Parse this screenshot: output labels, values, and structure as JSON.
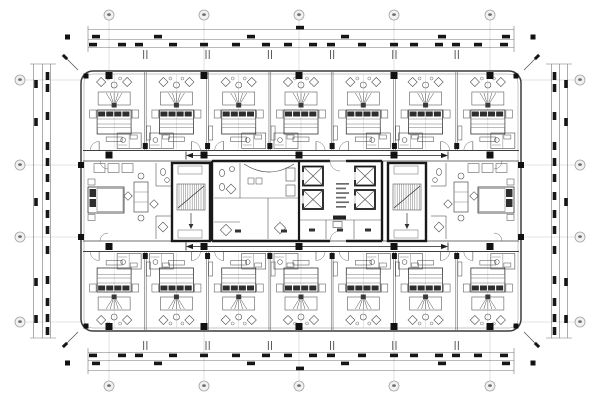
{
  "page": {
    "width": 600,
    "height": 400,
    "background": "#ffffff"
  },
  "colors": {
    "ink": "#474747",
    "wall": "#191919",
    "faint": "#c7c7c7",
    "mid": "#767676",
    "smudge": "#666666",
    "bubble_fill": "#f1f1f1",
    "bubble_stroke": "#a2a2a2",
    "paper": "#ffffff"
  },
  "grid": {
    "vertical_axes_x": [
      109,
      204,
      299,
      394,
      490
    ],
    "horizontal_axes_y": [
      80,
      165,
      237,
      322
    ],
    "top_bubbles": [
      {
        "x": 109,
        "label": ""
      },
      {
        "x": 204,
        "label": ""
      },
      {
        "x": 299,
        "label": ""
      },
      {
        "x": 394,
        "label": ""
      },
      {
        "x": 490,
        "label": ""
      }
    ],
    "bottom_bubbles": [
      {
        "x": 109,
        "label": ""
      },
      {
        "x": 204,
        "label": ""
      },
      {
        "x": 299,
        "label": ""
      },
      {
        "x": 394,
        "label": ""
      },
      {
        "x": 490,
        "label": ""
      }
    ],
    "left_bubbles": [
      {
        "y": 80,
        "label": ""
      },
      {
        "y": 165,
        "label": ""
      },
      {
        "y": 237,
        "label": ""
      },
      {
        "y": 322,
        "label": ""
      }
    ],
    "right_bubbles": [
      {
        "y": 80,
        "label": ""
      },
      {
        "y": 165,
        "label": ""
      },
      {
        "y": 237,
        "label": ""
      },
      {
        "y": 322,
        "label": ""
      }
    ],
    "bubble_radius": 5,
    "top_cy": 15,
    "bottom_cy": 386,
    "left_cx": 20,
    "right_cx": 580
  },
  "building": {
    "x": 81,
    "y": 71,
    "w": 440,
    "h": 260,
    "rx": 12
  },
  "rooms": {
    "band_x0": 83,
    "band_x1": 519,
    "top_count": 7,
    "bottom_count": 7,
    "top_band": [
      72,
      150
    ],
    "bottom_band": [
      252,
      330
    ]
  },
  "corridors": {
    "top_wall_y": [
      150.5,
      161
    ],
    "bottom_wall_y": [
      241,
      251.5
    ],
    "arrow_top_y": 155.5,
    "arrow_bottom_y": 246.5,
    "arrow_x0": 186,
    "arrow_x1": 448
  },
  "core": {
    "x": 212,
    "y": 161,
    "w": 170,
    "h": 80,
    "divider_x": 299,
    "elevators": [
      {
        "x": 303,
        "y": 166.5,
        "w": 20,
        "h": 19
      },
      {
        "x": 303,
        "y": 190,
        "w": 20,
        "h": 19
      },
      {
        "x": 355,
        "y": 166.5,
        "w": 20,
        "h": 19
      },
      {
        "x": 355,
        "y": 190,
        "w": 20,
        "h": 19
      }
    ],
    "stair_left": {
      "x": 172,
      "y": 163,
      "w": 38,
      "h": 78
    },
    "stair_right": {
      "x": 388,
      "y": 163,
      "w": 38,
      "h": 78
    },
    "lobby_text_block": {
      "x": 336,
      "y": 183,
      "lines": 6,
      "line_w": 13,
      "line_gap": 4.6
    },
    "room_label_dots": [
      [
        238,
        231
      ],
      [
        284,
        231
      ],
      [
        312,
        230
      ],
      [
        340,
        230
      ],
      [
        368,
        230
      ]
    ],
    "pantry_block": {
      "x": 333,
      "y": 215.5,
      "w": 13,
      "h": 4
    }
  },
  "dim": {
    "top_lines_y": [
      29.5,
      39.5,
      47.5
    ],
    "bottom_lines_y": [
      352.5,
      360.5,
      370.5
    ],
    "left_lines_x": [
      33.5,
      42.5,
      50.5
    ],
    "right_lines_x": [
      551.5,
      559.5,
      567.5
    ],
    "h_span": [
      88,
      514
    ],
    "v_span": [
      64,
      338
    ],
    "top_inner_blobs_x": [
      93,
      122,
      139,
      173,
      204,
      236,
      266,
      288,
      313,
      331,
      362,
      394,
      414,
      439,
      456,
      478,
      504
    ],
    "top_mid_blobs_x": [
      96,
      158,
      251,
      345,
      442,
      506
    ],
    "overall_blob_x": 300,
    "left_inner_blobs_y": [
      76,
      88,
      116,
      146,
      162,
      178,
      196,
      214,
      230,
      250,
      280,
      302,
      318,
      331
    ],
    "left_outer_blobs_y": [
      84,
      122,
      202,
      282,
      319
    ],
    "end_squares": [
      [
        67.5,
        37
      ],
      [
        533,
        37
      ],
      [
        67.5,
        363
      ],
      [
        533,
        363
      ]
    ],
    "window_tick_pairs_x": [
      145.3,
      207.6,
      269.9,
      332.1,
      394.4,
      456.7
    ]
  },
  "columns": {
    "xs": [
      109,
      204,
      299,
      394,
      490
    ],
    "ys": [
      75.5,
      155,
      246.5,
      326.5
    ],
    "size": 7,
    "side_columns": [
      [
        81,
        165
      ],
      [
        81,
        237
      ],
      [
        521,
        165
      ],
      [
        521,
        237
      ]
    ],
    "corner_columns": [
      [
        86,
        76
      ],
      [
        516,
        76
      ],
      [
        86,
        326
      ],
      [
        516,
        326
      ]
    ]
  }
}
